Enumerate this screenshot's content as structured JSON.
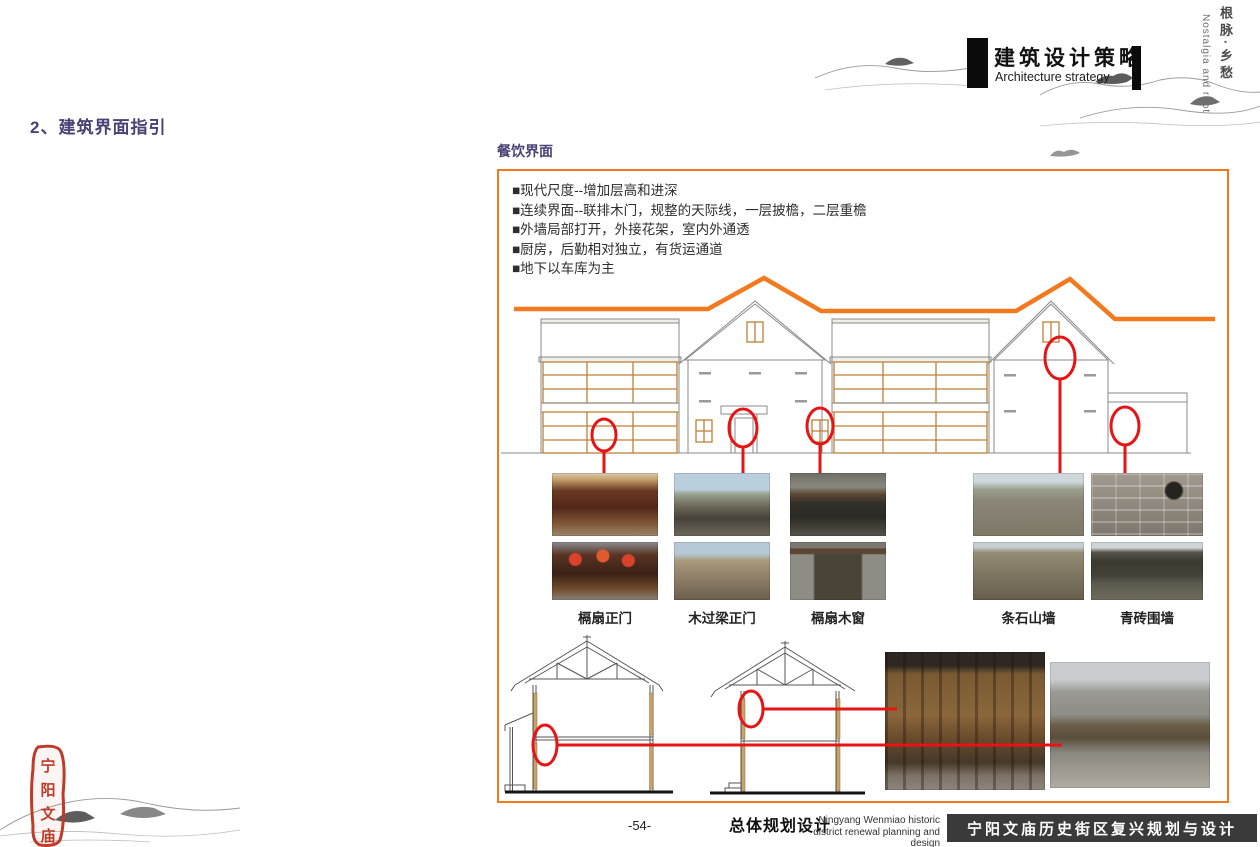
{
  "header": {
    "title": "建筑设计策略",
    "subtitle": "Architecture strategy",
    "side_text_cn": "根脉·乡愁",
    "side_text_en": "Nostalgia and root"
  },
  "section_heading": "2、建筑界面指引",
  "panel": {
    "label": "餐饮界面",
    "bullets": [
      "■现代尺度--增加层高和进深",
      "■连续界面--联排木门，规整的天际线，一层披檐，二层重檐",
      "■外墙局部打开，外接花架，室内外通透",
      "■厨房，后勤相对独立，有货运通道",
      "■地下以车库为主"
    ],
    "photo_captions": [
      "槅扇正门",
      "木过梁正门",
      "槅扇木窗",
      "条石山墙",
      "青砖围墙"
    ]
  },
  "footer": {
    "page_number": "-54-",
    "title_cn": "总体规划设计",
    "subtitle_en_line1": "Ningyang Wenmiao historic",
    "subtitle_en_line2": "district renewal planning and design",
    "banner": "宁阳文庙历史街区复兴规划与设计"
  },
  "seal": {
    "chars": [
      "宁",
      "阳",
      "文",
      "庙"
    ]
  },
  "colors": {
    "accent_orange": "#F2791E",
    "heading_purple": "#4A4274",
    "annotation_red": "#E51515",
    "banner_bg": "#3A3A3A",
    "lattice_wood": "#BD8136"
  }
}
